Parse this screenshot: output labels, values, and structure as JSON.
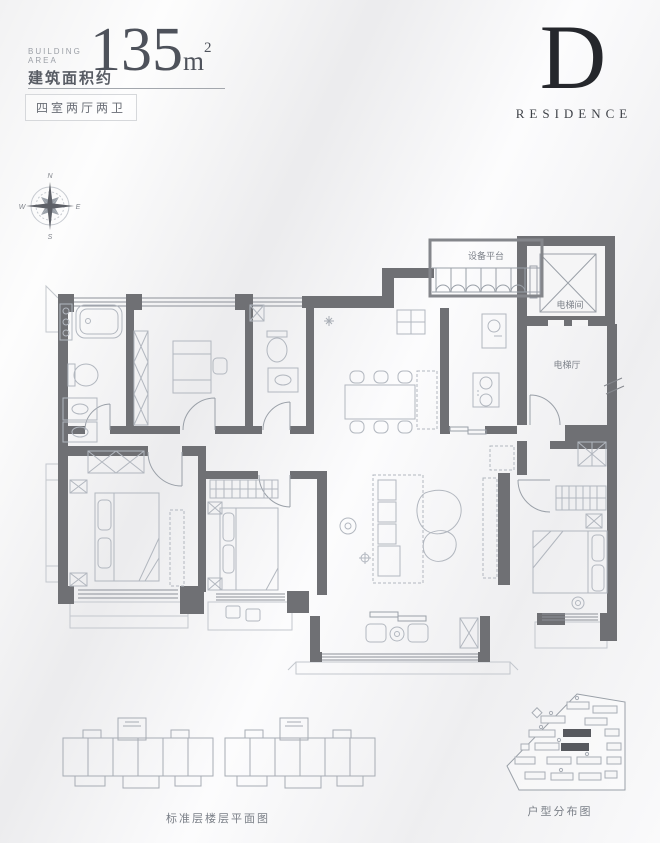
{
  "header": {
    "building_area_line1": "BUILDING",
    "building_area_line2": "AREA",
    "area_value": "135",
    "area_unit": "m",
    "area_exponent": "2",
    "area_label_cn": "建筑面积约",
    "layout_tag": "四室两厅两卫"
  },
  "logo": {
    "letter": "D",
    "word": "RESIDENCE"
  },
  "compass": {
    "north": "N",
    "east": "E",
    "south": "S",
    "west": "W"
  },
  "plan": {
    "labels": {
      "equipment_platform": "设备平台",
      "elevator_room": "电梯间",
      "elevator_hall": "电梯厅"
    }
  },
  "footer": {
    "standard_floor_caption": "标准层楼层平面图",
    "distribution_caption": "户型分布图"
  },
  "colors": {
    "wall": "#6f7074",
    "accent_dark": "#25272c",
    "line": "#9aa0a8",
    "furniture": "#b2b7bf",
    "text_primary": "#4e525b",
    "text_muted": "#8f939b"
  }
}
